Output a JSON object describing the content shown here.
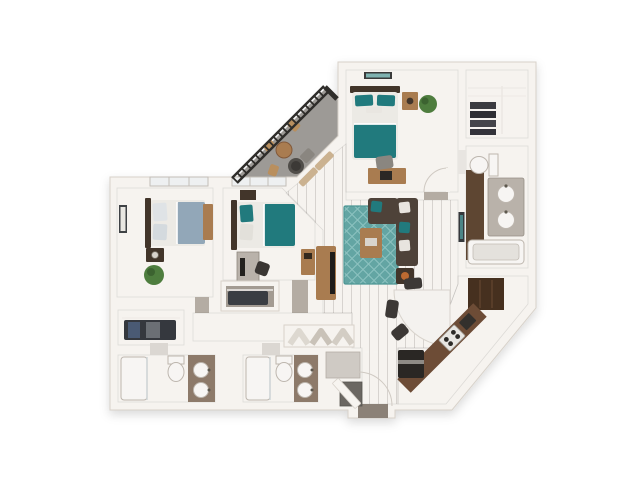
{
  "scene": {
    "type": "3d-floor-plan-rendering",
    "view": "top-down dollhouse perspective",
    "background": "#ffffff",
    "visible_text": "none"
  },
  "colors": {
    "page_bg": "#ffffff",
    "wall": "#f6f3ef",
    "wall_edge": "#d8d2ca",
    "carpet": "#b4aca3",
    "carpet_dark": "#aba398",
    "closet_floor": "#a39b92",
    "wood_floor": "#8b8177",
    "balcony_floor": "#9d9a96",
    "tile": "#e8e5e1",
    "tile_dark": "#dbd7d2",
    "teal": "#217a7d",
    "blue_gray": "#92a7b8",
    "linen": "#eceae5",
    "sofa": "#4e4239",
    "rug": "#63a5a3",
    "rug_lattice": "#93c7c4",
    "wood_furniture": "#a97c50",
    "dark_furniture": "#42352a",
    "counter": "#6d4c36",
    "pantry": "#46301f",
    "appliance": "#2a2724",
    "vanity": "#8d7a6a",
    "railing": "#2f2d2a",
    "plant": "#4e7d3e",
    "orange": "#bc6a31",
    "chair_gray": "#8a8680"
  },
  "floor_plan": {
    "rooms": [
      {
        "name": "master-bedroom",
        "floor": "carpet",
        "furniture": [
          "teal-bed",
          "headboard",
          "pillows",
          "wall-art",
          "nightstand",
          "lamp",
          "potted-plant",
          "desk",
          "desk-chair",
          "door-swing"
        ]
      },
      {
        "name": "master-walk-in-closet",
        "floor": "carpet",
        "furniture": [
          "shelving",
          "folded-clothes-stacks",
          "hanging-rods"
        ]
      },
      {
        "name": "master-bathroom",
        "floor": "tile",
        "furniture": [
          "toilet",
          "double-sink-vanity",
          "bathtub",
          "dark-wood-floor-strip"
        ]
      },
      {
        "name": "balcony",
        "floor": "concrete",
        "furniture": [
          "railing-with-posts",
          "bistro-table",
          "outdoor-chairs",
          "round-fire-table",
          "lounge-chair"
        ]
      },
      {
        "name": "living-room",
        "floor": "wood-plank",
        "furniture": [
          "sectional-sofa",
          "accent-pillows",
          "area-rug-teal-lattice",
          "coffee-table",
          "side-table",
          "media-console",
          "tv",
          "wall-art",
          "balcony-door-curtains"
        ]
      },
      {
        "name": "dining-area",
        "floor": "wood-plank",
        "furniture": [
          "fan-shaped-white-table",
          "dining-chairs"
        ]
      },
      {
        "name": "kitchen",
        "floor": "white-tile",
        "furniture": [
          "angled-brown-counter",
          "range-stove",
          "countertop-appliance",
          "refrigerator",
          "tall-pantry-cabinets"
        ]
      },
      {
        "name": "entry",
        "floor": "wood-plank",
        "furniture": [
          "front-door-swing",
          "coat-closet",
          "utility-closet"
        ]
      },
      {
        "name": "hallway",
        "floor": "carpet",
        "furniture": [
          "linen-closet",
          "folded-towels"
        ]
      },
      {
        "name": "bedroom-2",
        "floor": "carpet",
        "furniture": [
          "teal-bed",
          "nightstand",
          "desk-with-monitor",
          "desk-chair",
          "dresser",
          "reach-in-closet",
          "window"
        ]
      },
      {
        "name": "bedroom-3",
        "floor": "carpet",
        "furniture": [
          "blue-gray-bed",
          "nightstand",
          "lamp",
          "wall-art",
          "potted-plant",
          "slim-dresser",
          "walk-in-closet-with-hanging-clothes",
          "window"
        ]
      },
      {
        "name": "bathroom-2",
        "floor": "tile",
        "furniture": [
          "tub-shower",
          "toilet",
          "vanity-with-two-sinks"
        ]
      },
      {
        "name": "bathroom-3",
        "floor": "tile",
        "furniture": [
          "tub-shower",
          "toilet",
          "vanity-with-two-sinks"
        ]
      }
    ]
  }
}
